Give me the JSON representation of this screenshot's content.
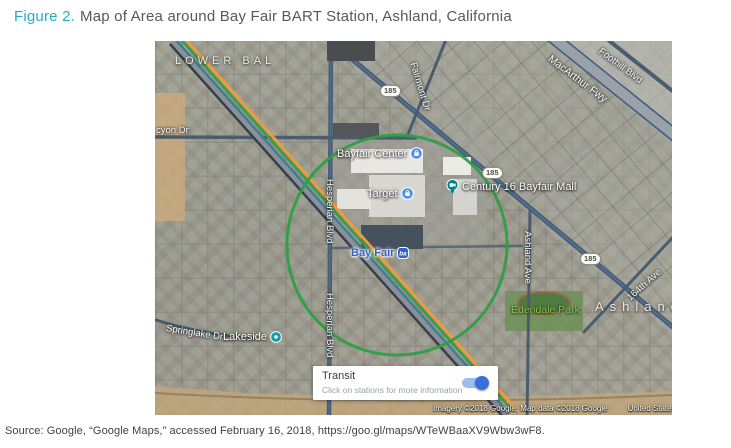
{
  "figure": {
    "label": "Figure 2.",
    "title": "Map of Area around Bay Fair BART Station, Ashland, California"
  },
  "source": "Source: Google, “Google Maps,” accessed February 16, 2018, https://goo.gl/maps/WTeWBaaXV9Wbw3wF8.",
  "map": {
    "neighborhoods": {
      "lower_bal": "LOWER BAL",
      "ashland": "Ashland"
    },
    "roads": {
      "halcyon": "cyon Dr",
      "fairmont": "Fairmont Dr",
      "macarthur": "MacArthur Fwy",
      "foothill": "Foothill Blvd",
      "hesperian_upper": "Hesperian Blvd",
      "hesperian_lower": "Hesperian Blvd",
      "springlake": "Springlake Dr",
      "ashland_ave": "Ashland Ave",
      "ave_164": "164th Ave"
    },
    "route_shield": "185",
    "pois": {
      "bayfair_center": "Bayfair Center",
      "target": "Target",
      "century": "Century 16 Bayfair Mall",
      "bay_fair_station": "Bay Fair",
      "lakeside": "Lakeside",
      "edendale_park": "Edendale Park"
    },
    "transit_card": {
      "title": "Transit",
      "subtitle": "Click on stations for more information",
      "toggle_on": true
    },
    "attribution": {
      "credits": "Imagery ©2018 Google, Map data ©2018 Google",
      "region": "United States",
      "terms": "Terms"
    },
    "colors": {
      "figure_accent_teal": "#2baac5",
      "circle_green": "#2f9e44",
      "station_label_blue": "#3f5fc0",
      "bart_line_orange": "#ef9b3a",
      "bart_line_green": "#3f9b4f",
      "toggle_blue": "#3a6fd8",
      "park_label_green": "#8cc152"
    }
  }
}
